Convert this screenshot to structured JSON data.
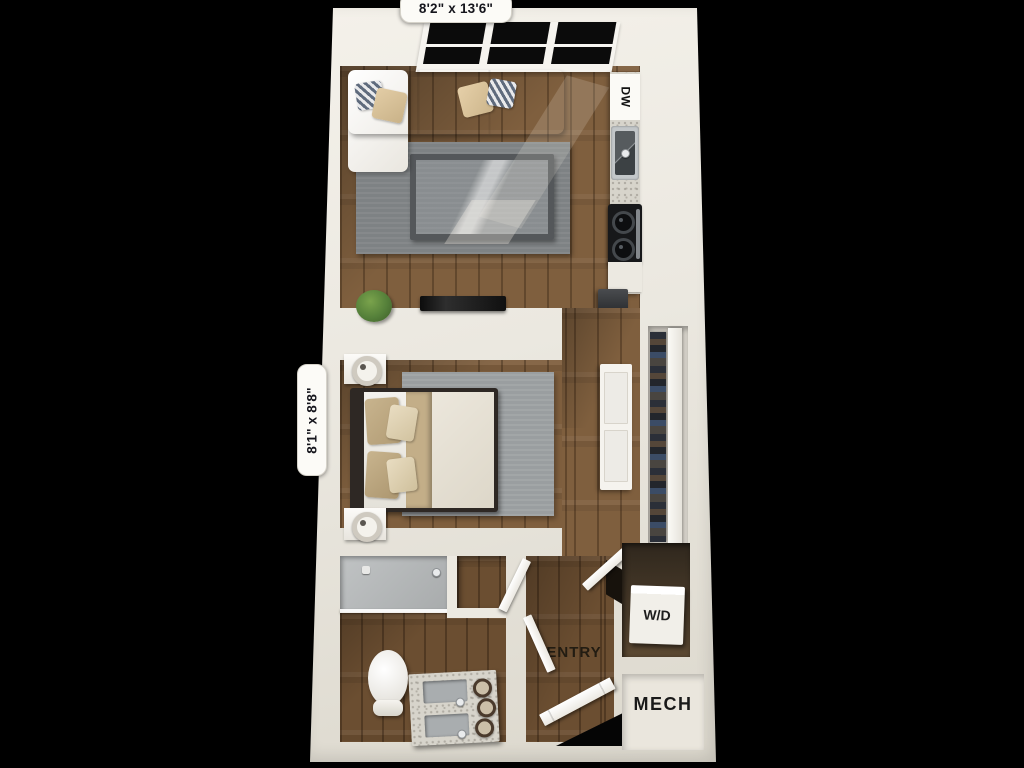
{
  "type": "3d-floor-plan",
  "background_color": "#000000",
  "dimension_labels": {
    "living_area": "8'2\" x 13'6\"",
    "bedroom_area": "8'1\" x 8'8\""
  },
  "room_labels": {
    "entry": "ENTRY",
    "mechanical": "MECH"
  },
  "appliance_labels": {
    "dishwasher": "DW",
    "washer_dryer": "W/D"
  },
  "colors": {
    "wall": "#ece9e1",
    "wood_floor": "#7f5f3e",
    "living_rug": "#7e8284",
    "bedroom_rug": "#9a9ea0",
    "sofa": "#f1efeb",
    "pillow_tan": "#d9c39c",
    "pillow_striped": "#5f6b7d",
    "bed_blanket": "#c3ae88",
    "countertop": "#d7d4cb",
    "appliance_black": "#17181a",
    "shower_tile": "#b3b6b7",
    "plant": "#5f8a3c",
    "window_glass": "#0b0b0b",
    "label_text": "#161616",
    "label_pill": "#fcfbf7"
  }
}
